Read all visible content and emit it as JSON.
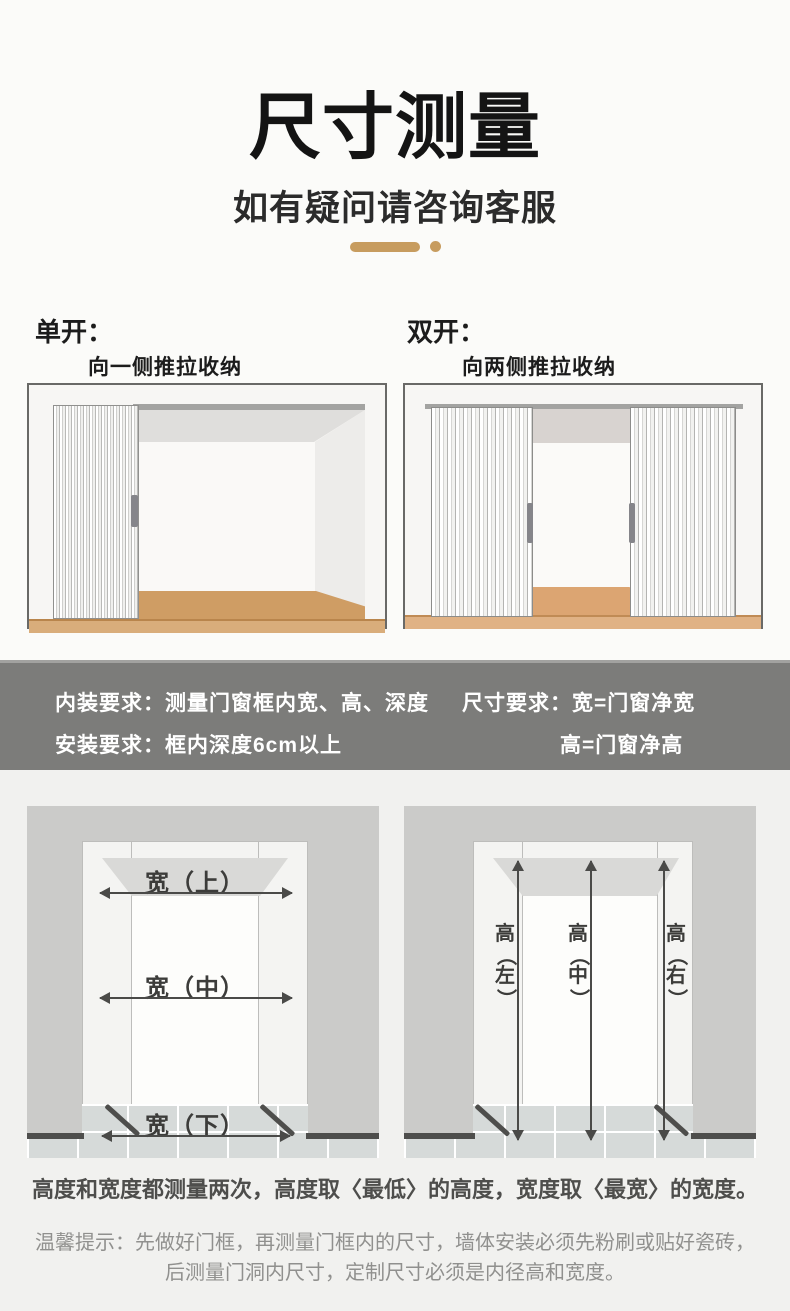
{
  "header": {
    "title": "尺寸测量",
    "subtitle": "如有疑问请咨询客服"
  },
  "sections": {
    "single": {
      "label": "单开：",
      "caption": "向一侧推拉收纳"
    },
    "double": {
      "label": "双开：",
      "caption": "向两侧推拉收纳"
    }
  },
  "requirements": {
    "interior": "内装要求：测量门窗框内宽、高、深度",
    "install": "安装要求：框内深度6cm以上",
    "size": "尺寸要求：宽=门窗净宽",
    "height": "高=门窗净高"
  },
  "measure": {
    "width_labels": [
      "宽（上）",
      "宽（中）",
      "宽（下）"
    ],
    "height_labels": [
      "高（左）",
      "高（中）",
      "高（右）"
    ]
  },
  "notes": {
    "main": "高度和宽度都测量两次，高度取〈最低〉的高度，宽度取〈最宽〉的宽度。",
    "tip_line1": "温馨提示：先做好门框，再测量门框内的尺寸，墙体安装必须先粉刷或贴好瓷砖，",
    "tip_line2": "后测量门洞内尺寸，定制尺寸必须是内径高和宽度。"
  },
  "colors": {
    "accent_gold": "#c79c5f",
    "band_bg": "#7c7c7a",
    "panel_bg": "#cbcbc9",
    "floor_wood": "#cf9d64",
    "floor_wood_light": "#d9ad7b",
    "tile": "#d6dad9",
    "arrow": "#4a4a48"
  }
}
